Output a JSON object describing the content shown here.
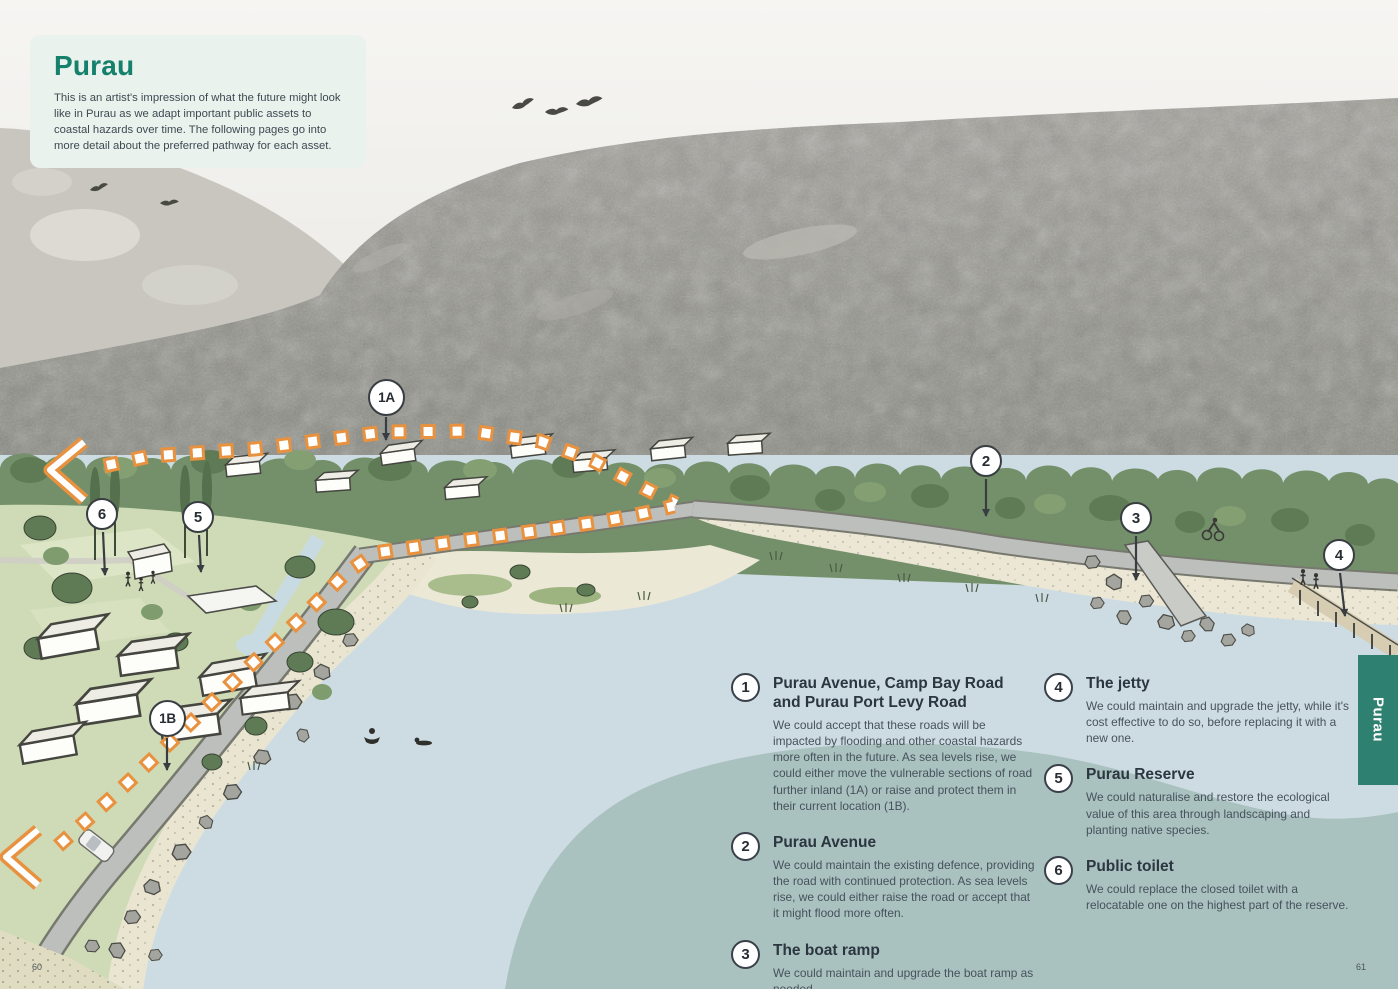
{
  "page": {
    "left_page_number": "60",
    "right_page_number": "61"
  },
  "side_tab": {
    "label": "Purau"
  },
  "intro_card": {
    "title": "Purau",
    "body": "This is an artist's impression of what the future might look like in Purau as we adapt important public assets to coastal hazards over time. The following pages go into more detail about the preferred pathway for each asset."
  },
  "map_markers": [
    {
      "label": "1A"
    },
    {
      "label": "1B"
    },
    {
      "label": "2"
    },
    {
      "label": "3"
    },
    {
      "label": "4"
    },
    {
      "label": "5"
    },
    {
      "label": "6"
    }
  ],
  "legend": {
    "items": [
      {
        "number": "1",
        "title": "Purau Avenue, Camp Bay Road and Purau Port Levy Road",
        "body": "We could accept that these roads will be impacted by flooding and other coastal hazards more often in the future. As sea levels rise, we could either move the vulnerable sections of road further inland (1A) or raise and protect them in their current location (1B)."
      },
      {
        "number": "2",
        "title": "Purau Avenue",
        "body": "We could maintain the existing defence, providing the road with continued protection. As sea levels rise, we could either raise the road or accept that it might flood more often."
      },
      {
        "number": "3",
        "title": "The boat ramp",
        "body": "We could maintain and upgrade the boat ramp as needed."
      },
      {
        "number": "4",
        "title": "The jetty",
        "body": "We could maintain and upgrade the jetty, while it's cost effective to do so, before replacing it with a new one."
      },
      {
        "number": "5",
        "title": "Purau Reserve",
        "body": "We could naturalise and restore the ecological value of this area through landscaping and planting native species."
      },
      {
        "number": "6",
        "title": "Public toilet",
        "body": "We could replace the closed toilet with a relocatable one on the highest part of the reserve."
      }
    ]
  },
  "colors": {
    "accent_teal": "#15806b",
    "tab_teal": "#2e8170",
    "card_mint": "#e9f2ec",
    "route_orange": "#e8923f",
    "water": "#cddce3",
    "shade_blob": "#a9c1bf",
    "tree_green": "#74906a",
    "sand": "#ebe7d4",
    "road_gray": "#bdbfbc"
  }
}
